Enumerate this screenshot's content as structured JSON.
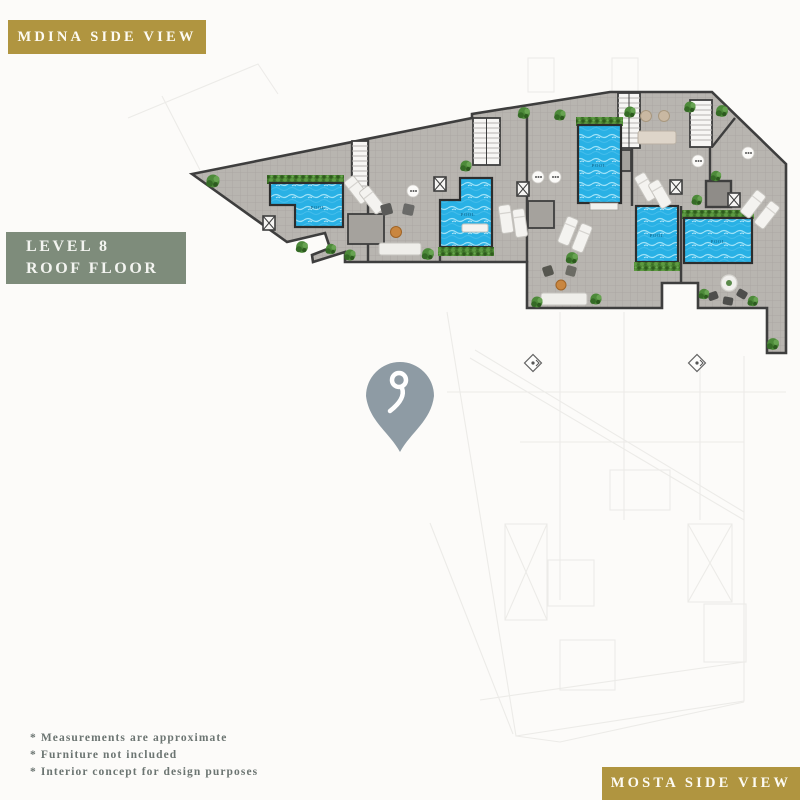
{
  "tags": {
    "mdina": "MDINA SIDE VIEW",
    "mosta": "MOSTA SIDE VIEW"
  },
  "level_badge": {
    "line1": "LEVEL 8",
    "line2": "ROOF FLOOR"
  },
  "footnotes": [
    "* Measurements are approximate",
    "* Furniture not included",
    "* Interior concept for design purposes"
  ],
  "plan": {
    "pool_label": "POOL",
    "pool_count": 5,
    "map_pin_icon": "location-pin",
    "stair_count": 4
  },
  "colors": {
    "accent_gold": "#b09540",
    "sage_green": "#7e8c7b",
    "pool_blue": "#29b1e5",
    "terrace_gray": "#b8b5b0",
    "wall_dark": "#3e3e3e",
    "hedge_green": "#47812f",
    "pin_gray_blue": "#8e9ba4",
    "note_text": "#6c7572"
  }
}
